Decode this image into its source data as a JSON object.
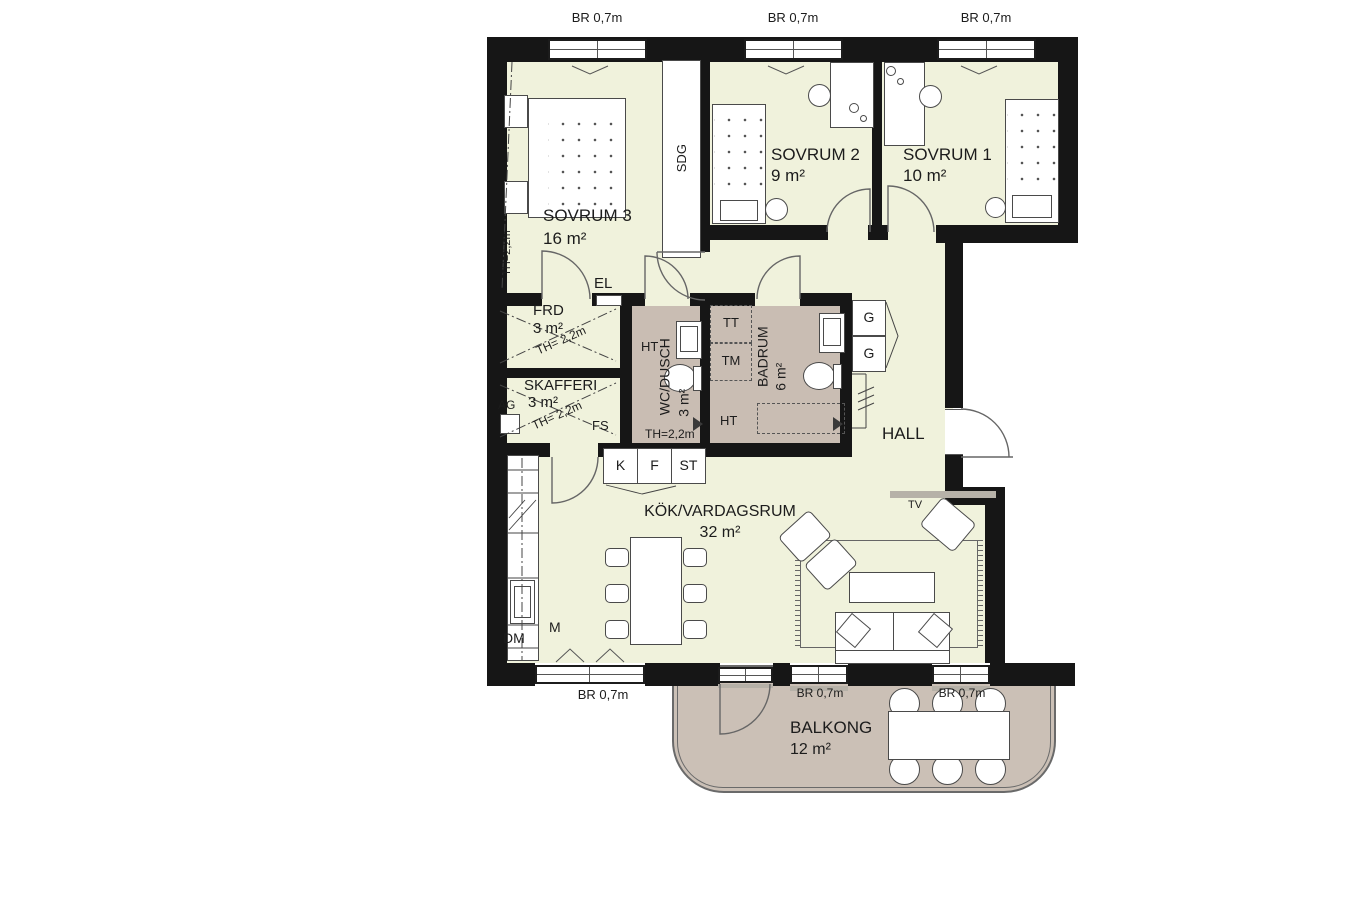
{
  "plan": {
    "type": "apartment-floorplan",
    "colors": {
      "room_fill": "#f0f2dc",
      "wet_room_fill": "#c9bdb3",
      "balcony_fill": "#cbc0b6",
      "wall": "#161616",
      "sill_gray": "#b6b1a8"
    },
    "rooms": {
      "sovrum3": {
        "name": "SOVRUM 3",
        "area": "16 m²",
        "ceiling_height": "TH=2,2m"
      },
      "sovrum2": {
        "name": "SOVRUM 2",
        "area": "9 m²"
      },
      "sovrum1": {
        "name": "SOVRUM 1",
        "area": "10 m²"
      },
      "frd": {
        "name": "FRD",
        "area": "3 m²",
        "ceiling_height": "TH= 2,2m"
      },
      "skafferi": {
        "name": "SKAFFERI",
        "area": "3 m²",
        "ceiling_height": "TH= 2,2m"
      },
      "wc_dusch": {
        "name": "WC/DUSCH",
        "area": "3 m²",
        "ceiling_height": "TH=2,2m"
      },
      "badrum": {
        "name": "BADRUM",
        "area": "6 m²"
      },
      "hall": {
        "name": "HALL"
      },
      "kok": {
        "name": "KÖK/VARDAGSRUM",
        "area": "32 m²"
      },
      "balkong": {
        "name": "BALKONG",
        "area": "12 m²"
      }
    },
    "labels": {
      "window_width": "BR 0,7m",
      "sdg": "SDG",
      "el": "EL",
      "ht": "HT",
      "tt": "TT",
      "tm": "TM",
      "g": "G",
      "kyl": "K",
      "frys": "F",
      "stad": "ST",
      "dm": "DM",
      "m": "M",
      "ag": "AG",
      "fs": "FS",
      "tv": "TV"
    }
  }
}
